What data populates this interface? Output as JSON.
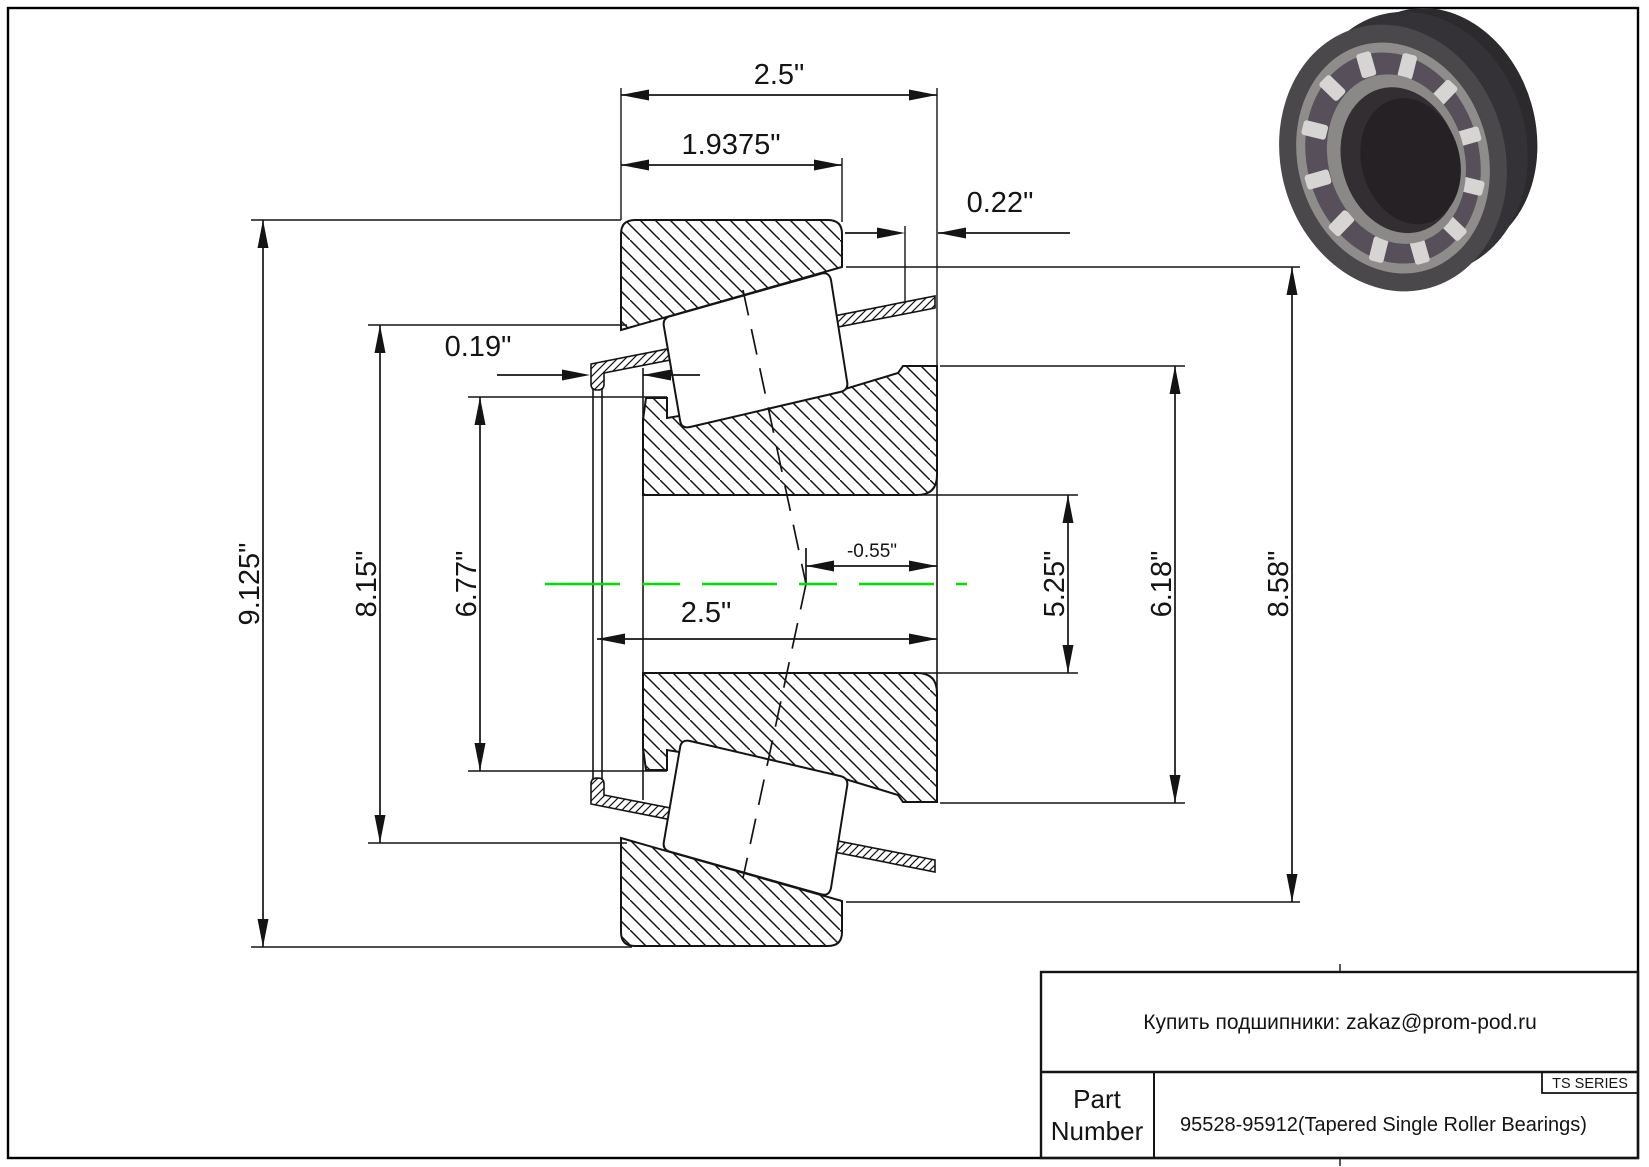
{
  "page": {
    "background": "#ffffff",
    "border_color": "#000000",
    "centerline_color": "#00e000",
    "line_color": "#141414"
  },
  "drawing": {
    "type": "tapered-roller-bearing-cross-section",
    "dimensions": {
      "overall_width": "2.5\"",
      "cup_width": "1.9375\"",
      "cone_standout": "0.22\"",
      "cage_clearance": "0.19\"",
      "od_housing": "9.125\"",
      "od_flange": "8.15\"",
      "od_cup_front": "6.77\"",
      "bore_width": "2.5\"",
      "effective_center": "-0.55\"",
      "bore_diameter": "5.25\"",
      "od_cup_small": "6.18\"",
      "od_cup": "8.58\""
    }
  },
  "title_block": {
    "contact": "Купить подшипники: zakaz@prom-pod.ru",
    "series_badge": "TS SERIES",
    "part_label_line1": "Part",
    "part_label_line2": "Number",
    "part_number": "95528-95912(Tapered Single Roller Bearings)"
  },
  "inset_image": {
    "name": "tapered-roller-bearing-3d-render",
    "ring_dark": "#39373a",
    "ring_face": "#4a484b",
    "rim_gray": "#8e8d8b",
    "cage_dark": "#574f5a",
    "roller_light": "#d6d5d3",
    "bore_dark": "#2b2528"
  }
}
